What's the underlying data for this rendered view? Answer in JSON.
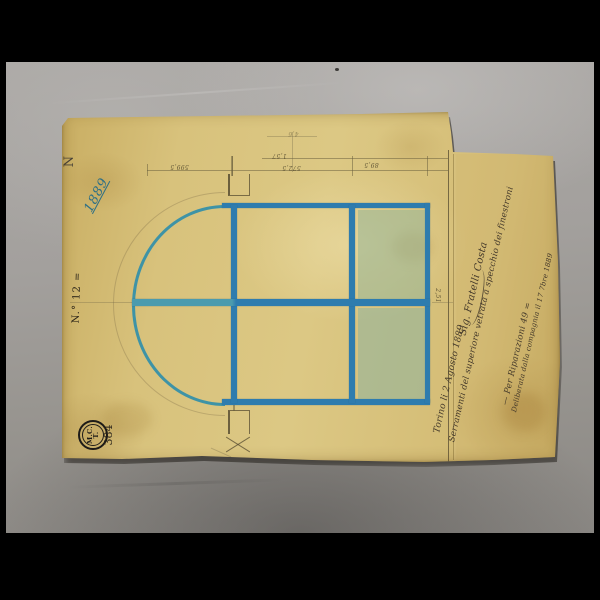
{
  "sheet": {
    "corner_letter": "N",
    "year_note": "1889",
    "number_label": "N.° 12 =",
    "stamp": {
      "top": "M.C.",
      "bottom": "T.",
      "number": "384"
    },
    "notes": {
      "date": "Torino li 2 Agosto 1889",
      "subject": "Serramenti del superiore vetrata a specchio dei finestroni",
      "signature": "Sig. Fratelli Costa",
      "order": "— Per Riparazioni 49 =",
      "approval": "Deliberata dalla compagnia il 17 7bre 1889"
    },
    "dimensions": {
      "overall": "1,57",
      "seg_left": "599,5",
      "seg_mid": "572,5",
      "seg_right": "89,5",
      "height": "2,51",
      "small": "4,6"
    },
    "colors": {
      "ink_blue": "#2e7cae",
      "arc_teal": "#3e93a6",
      "glass_green": "#93b497",
      "paper": "#d7c17a",
      "backdrop": "#9e9b98"
    }
  }
}
